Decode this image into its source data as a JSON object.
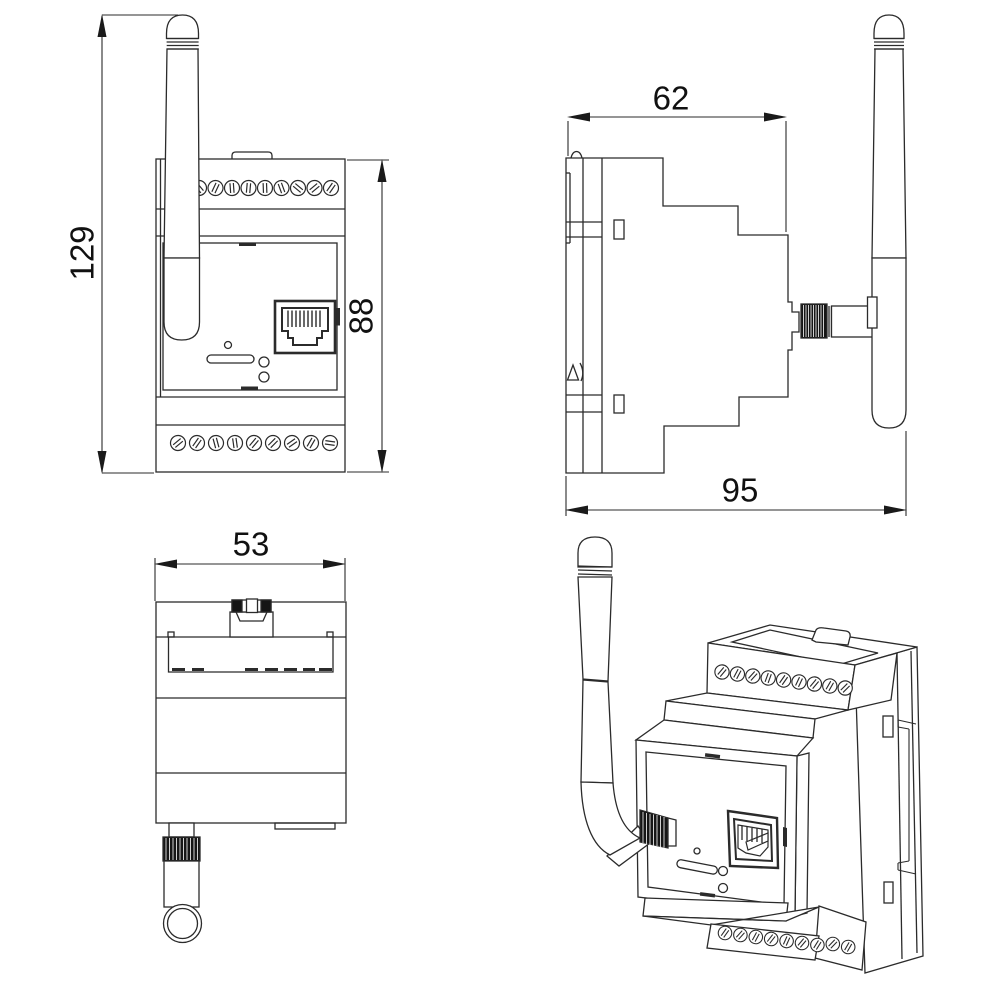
{
  "dimensions": {
    "front_overall_height": "129",
    "front_body_height": "88",
    "side_body_depth": "62",
    "side_overall_depth": "95",
    "top_body_width": "53"
  },
  "style": {
    "background": "#ffffff",
    "line_color": "#2b2b2b",
    "dim_text_color": "#111111",
    "knurl_fill": "#151515"
  }
}
